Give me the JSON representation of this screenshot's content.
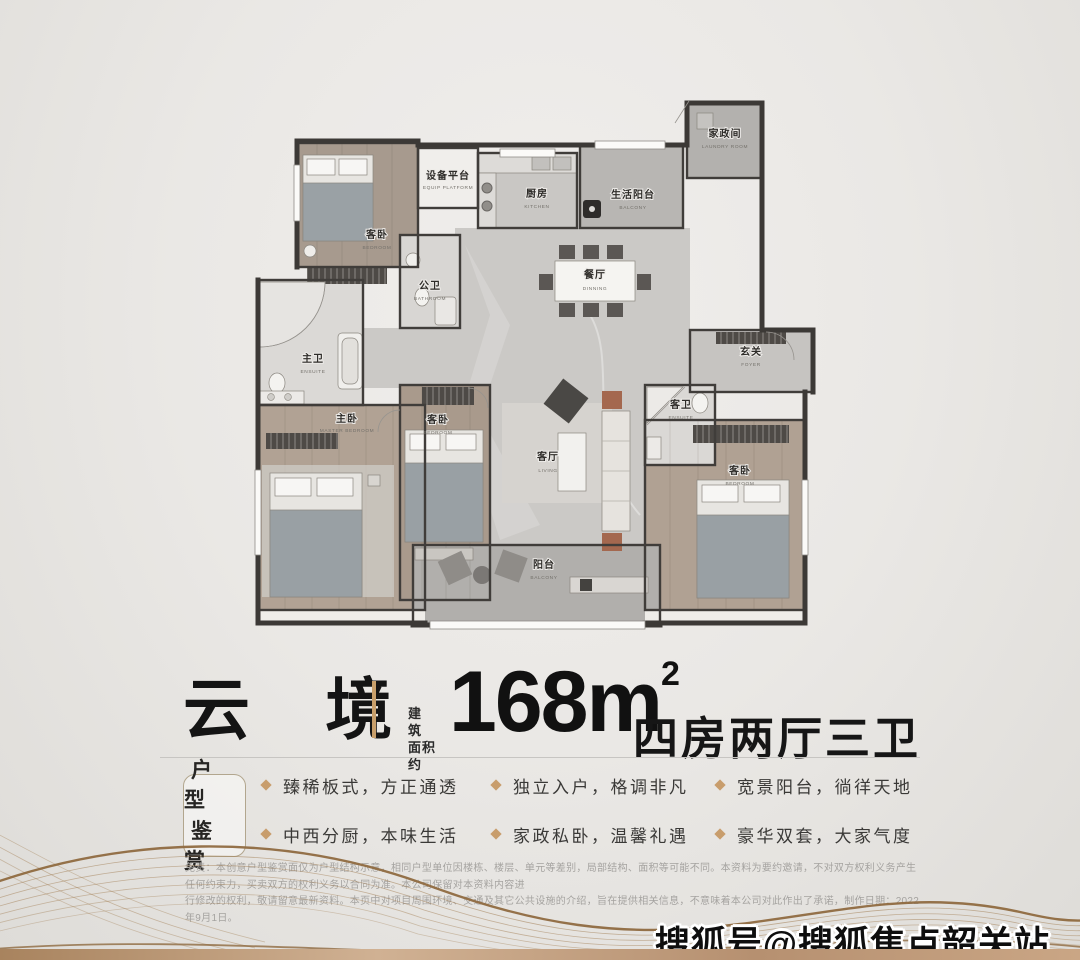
{
  "poster": {
    "watermark": "搜狐号@搜狐焦点韶关站"
  },
  "title": {
    "name": "云 境",
    "area_label_line1": "建 筑",
    "area_label_line2": "面积约",
    "area_value": "168m",
    "area_unit_sup": "2",
    "layout_text": "四房两厅三卫"
  },
  "features": {
    "badge_line1": "户型",
    "badge_line2": "鉴赏",
    "items": [
      "臻稀板式，方正通透",
      "独立入户，格调非凡",
      "宽景阳台，徜徉天地",
      "中西分厨，本味生活",
      "家政私卧，温馨礼遇",
      "豪华双套，大家气度"
    ]
  },
  "disclaimer": {
    "line1": "免责：本创意户型鉴赏面仅为户型结构示意，相同户型单位因楼栋、楼层、单元等差别，局部结构、面积等可能不同。本资料为要约邀请，不对双方权利义务产生任何约束力，买卖双方的权利义务以合同为准。本公司保留对本资料内容进",
    "line2": "行修改的权利，敬请留意最新资料。本页中对项目周围环境、交通及其它公共设施的介绍，旨在提供相关信息，不意味着本公司对此作出了承诺，制作日期：2022年9月1日。"
  },
  "floorplan": {
    "rooms": [
      {
        "name": "家政间",
        "en": "LAUNDRY ROOM"
      },
      {
        "name": "设备平台",
        "en": "EQUIP PLATFORM"
      },
      {
        "name": "厨房",
        "en": "KITCHEN"
      },
      {
        "name": "生活阳台",
        "en": "BALCONY"
      },
      {
        "name": "客卧",
        "en": "BEDROOM"
      },
      {
        "name": "公卫",
        "en": "BATHROOM"
      },
      {
        "name": "餐厅",
        "en": "DINNING"
      },
      {
        "name": "玄关",
        "en": "FOYER"
      },
      {
        "name": "主卫",
        "en": "ENSUITE"
      },
      {
        "name": "主卧",
        "en": "MASTER BEDROOM"
      },
      {
        "name": "客卧",
        "en": "BEDROOM"
      },
      {
        "name": "客厅",
        "en": "LIVING"
      },
      {
        "name": "客卫",
        "en": "ENSUITE"
      },
      {
        "name": "客卧",
        "en": "BEDROOM"
      },
      {
        "name": "阳台",
        "en": "BALCONY"
      }
    ]
  },
  "colors": {
    "accent_gold": "#c89d6c",
    "wall": "#403d3a",
    "bottom_bar": "#b28d68",
    "text_dark": "#1a1a1a"
  }
}
